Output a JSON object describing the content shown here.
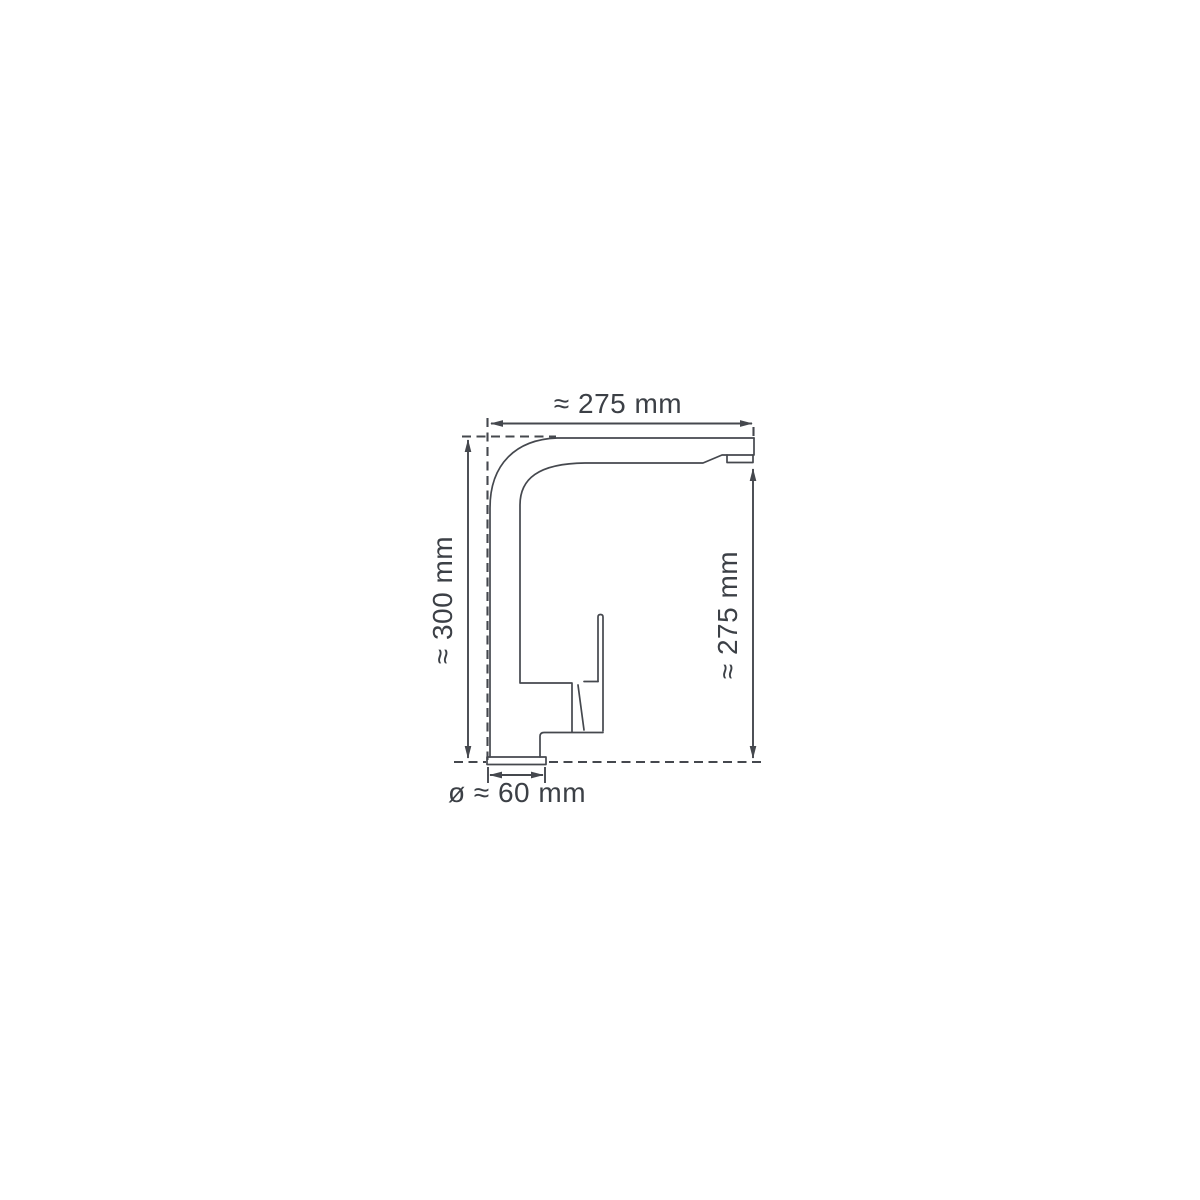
{
  "drawing": {
    "dimensions": {
      "top_width": "≈ 275 mm",
      "left_height": "≈ 300 mm",
      "right_height": "≈ 275 mm",
      "base_diameter": "ø ≈ 60 mm"
    },
    "colors": {
      "line": "#45484e",
      "text": "#3c4046",
      "background": "#ffffff"
    }
  }
}
